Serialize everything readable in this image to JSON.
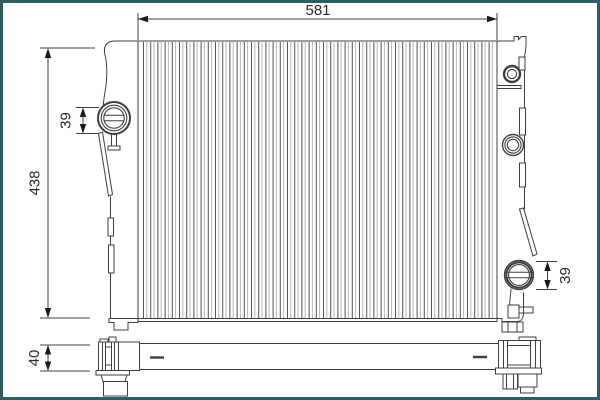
{
  "dimensions": {
    "width": {
      "label": "581"
    },
    "height": {
      "label": "438"
    },
    "left_neck": {
      "label": "39"
    },
    "right_cap": {
      "label": "39"
    },
    "depth": {
      "label": "40"
    }
  },
  "colors": {
    "frame_border": "#2e5d63",
    "line": "#3f3f3f",
    "fin": "#555555",
    "fin_light": "#b8b8b8",
    "background": "#ffffff",
    "text": "#2b2b2b"
  }
}
